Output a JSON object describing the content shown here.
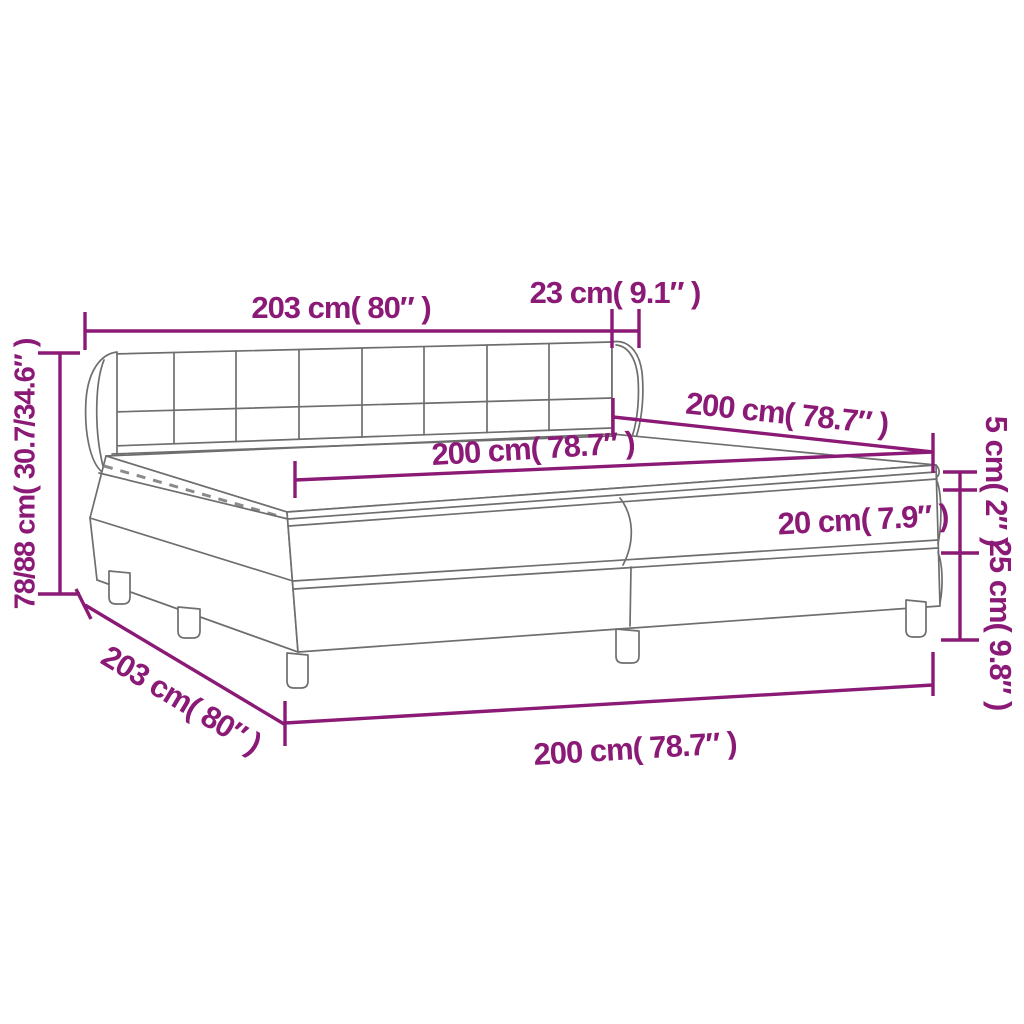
{
  "diagram": {
    "kind": "product-dimension-diagram",
    "subject": "box-spring-bed-with-headboard-mattress-and-topper",
    "accent_color": "#8b1a76",
    "line_art_color": "#6e6e6e",
    "background_color": "#ffffff",
    "labels": {
      "headboard_width": "203 cm( 80″ )",
      "headboard_depth": "23 cm( 9.1″ )",
      "length_top": "200 cm( 78.7″ )",
      "mattress_width": "200 cm( 78.7″ )",
      "topper_height": "5 cm( 2″ )",
      "mattress_height": "20 cm( 7.9″ )",
      "base_height": "25 cm( 9.8″ )",
      "bed_height": "78/88 cm( 30.7/34.6″ )",
      "base_length": "203 cm( 80″ )",
      "base_width": "200 cm( 78.7″ )"
    }
  }
}
